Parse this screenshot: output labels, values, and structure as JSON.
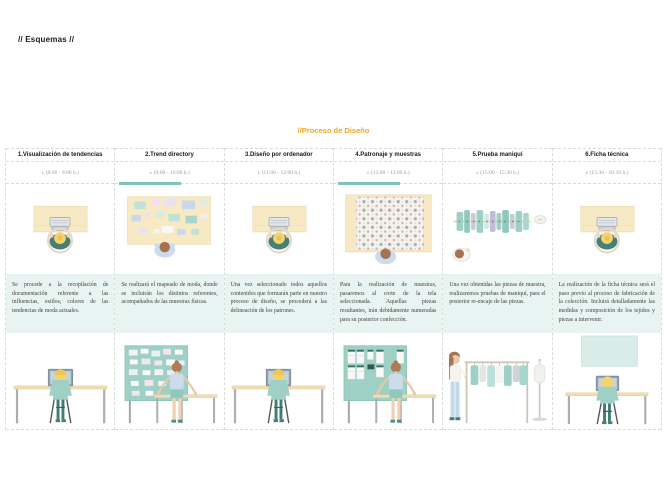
{
  "page": {
    "title": "// Esquemas //"
  },
  "process": {
    "title": "//Proceso de Diseño",
    "colors": {
      "title": "#F2A61E",
      "accent_bar": "#7FC4B6",
      "description_band": "#E8F4F1",
      "board_teal": "#9ED0C5",
      "desk_beige": "#F8E9C5"
    },
    "columns": [
      {
        "title": "1.Visualización de tendencias",
        "time": "± (8:00 - 9:00 h.)",
        "highlighted": false,
        "top_illustration": "desk-computer-topview",
        "bottom_illustration": "person-seated-at-desk",
        "description": "Se procede a la recopilación de documentación referente a las influencias, estilos, colores de las tendencias de moda actuales."
      },
      {
        "title": "2.Trend directory",
        "time": "± (9:00 - 10:00 h.)",
        "highlighted": true,
        "top_illustration": "moodboard-table-topview",
        "bottom_illustration": "person-standing-moodboard-table",
        "description": "Se realizará el mapeado de moda, donde se incluirán los distintos referentes, acompañados de las muestras físicas."
      },
      {
        "title": "3.Diseño por ordenador",
        "time": "± (11:00 - 12:00 h.)",
        "highlighted": false,
        "top_illustration": "desk-computer-topview",
        "bottom_illustration": "person-seated-at-desk",
        "description": "Una vez seleccionado todos aquellos contenidos que formarán parte en nuestro proceso de diseño, se procederá a las delineación de los patrones."
      },
      {
        "title": "4.Patronaje y muestras",
        "time": "± (12:00 - 13:00 h.)",
        "highlighted": true,
        "top_illustration": "fabric-cutting-table-topview",
        "bottom_illustration": "person-standing-pattern-board-table",
        "description": "Para la realización de muestras, pasaremos al corte de la tela seleccionada. Aquellas piezas resultantes, irán debidamente numeradas para su posterior confección."
      },
      {
        "title": "5.Prueba maniquí",
        "time": "± (15:00 - 15:30 h.)",
        "highlighted": false,
        "top_illustration": "garment-rack-topview",
        "bottom_illustration": "person-garment-rack-mannequin",
        "description": "Una vez obtenidas las piezas de muestra, realizaremos pruebas de maniquí, para el posterior re-encaje de las piezas."
      },
      {
        "title": "6.Ficha técnica",
        "time": "± (15:30 - 16:30 h.)",
        "highlighted": false,
        "top_illustration": "desk-computer-topview",
        "bottom_illustration": "person-seated-at-desk-with-board",
        "description": "La realización de la ficha técnica será el paso previo al proceso de fabricación de la colección. Incluirá detalladamente las medidas y composición de los tejidos y piezas a intervenir."
      }
    ]
  }
}
